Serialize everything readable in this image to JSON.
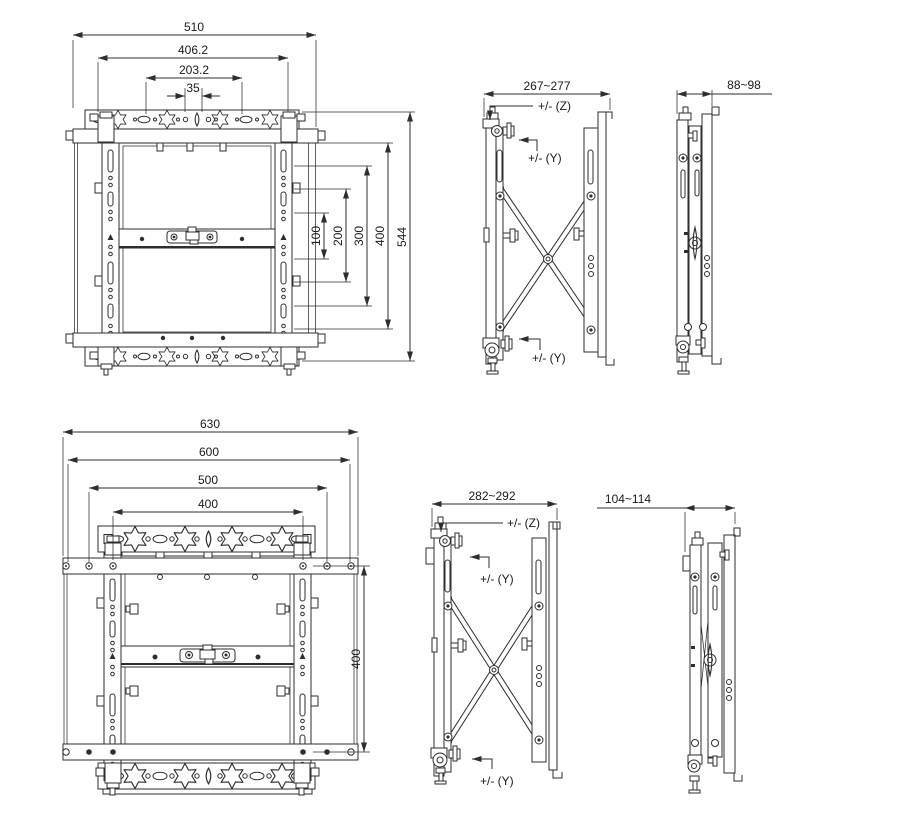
{
  "colors": {
    "line": "#2e2e2e",
    "background": "#ffffff"
  },
  "views": {
    "front_large": {
      "dim_510": "510",
      "dim_406_2": "406.2",
      "dim_203_2": "203.2",
      "dim_35": "35",
      "dim_100": "100",
      "dim_200": "200",
      "dim_300": "300",
      "dim_400": "400",
      "dim_544": "544"
    },
    "side_top_extended": {
      "dim_depth": "267~277",
      "label_z": "+/- (Z)",
      "label_y_top": "+/- (Y)",
      "label_y_bottom": "+/- (Y)"
    },
    "side_top_folded": {
      "dim_depth": "88~98"
    },
    "front_small": {
      "dim_630": "630",
      "dim_600": "600",
      "dim_500": "500",
      "dim_400": "400",
      "dim_400_v": "400"
    },
    "side_bottom_extended": {
      "dim_depth": "282~292",
      "label_z": "+/- (Z)",
      "label_y_top": "+/- (Y)",
      "label_y_bottom": "+/- (Y)"
    },
    "side_bottom_folded": {
      "dim_depth": "104~114"
    }
  }
}
